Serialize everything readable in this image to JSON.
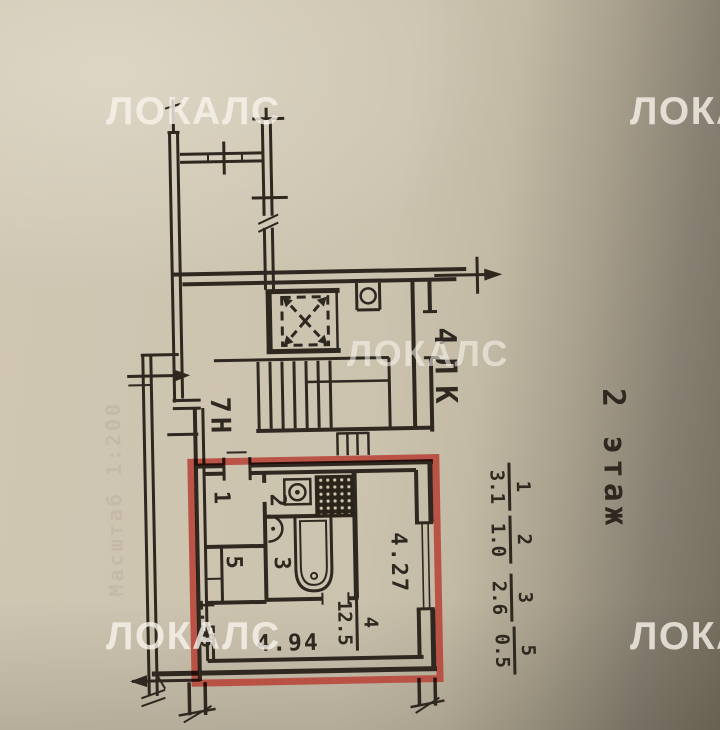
{
  "watermark": {
    "text": "ЛОКАЛС"
  },
  "floor_label": "2 этаж",
  "stairwell_label": "4ЛК",
  "premises_label": "7Н",
  "scale_note": "Масштаб 1:200",
  "rooms": {
    "room1": "1",
    "room2": "2",
    "room3": "3",
    "room5": "5"
  },
  "room4": {
    "num": "4",
    "den": "12.5"
  },
  "area_fractions": [
    {
      "num": "1",
      "den": "3.1"
    },
    {
      "num": "2",
      "den": "1.0"
    },
    {
      "num": "3",
      "den": "2.6"
    },
    {
      "num": "5",
      "den": "0.5"
    }
  ],
  "dimensions": {
    "d1": "4.27",
    "d2": "4.94",
    "d3": "1.56"
  },
  "colors": {
    "ink": "#2e2820",
    "highlight": "#b94a3c",
    "paper": "#c9c0ab",
    "watermark_text": "#f5f2ea"
  }
}
